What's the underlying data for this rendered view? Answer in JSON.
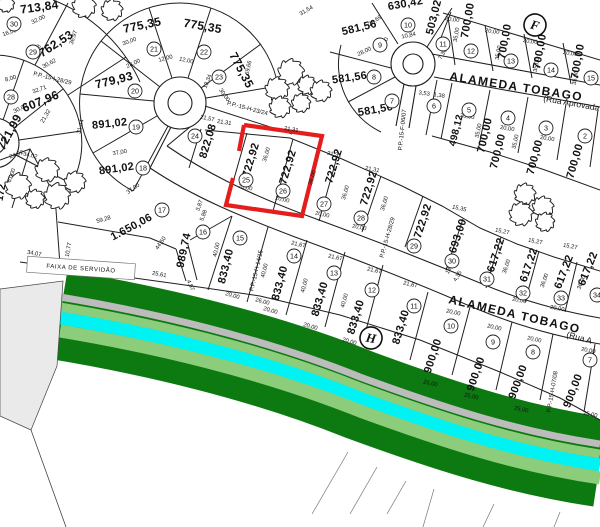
{
  "map": {
    "title_hint": "subdivision plat",
    "colors": {
      "line": "#1f1f1f",
      "highlight_red": "#e51d1d",
      "belt_dark_green": "#0d7a11",
      "belt_light_green": "#8bcd7b",
      "belt_cyan": "#00f2f2",
      "belt_gray": "#bcbcbc",
      "servitude_gray": "#eaeaea"
    },
    "street_labels": [
      {
        "t": "ALAMEDA TOBAGO",
        "x": 449,
        "y": 80,
        "r": 9,
        "s": 12,
        "b": 1,
        "ls": 1.4
      },
      {
        "t": "(Rua Aprovada",
        "x": 543,
        "y": 101,
        "r": 10,
        "s": 8.5,
        "b": 0,
        "ls": 0
      },
      {
        "t": "ALAMEDA TOBAGO",
        "x": 448,
        "y": 303,
        "r": 13,
        "s": 12,
        "b": 1,
        "ls": 1.4
      },
      {
        "t": "(Rua A",
        "x": 566,
        "y": 337,
        "r": 15,
        "s": 8.5,
        "b": 0,
        "ls": 0
      }
    ],
    "boxed_labels": [
      {
        "t": "FAIXA DE SERVIDÃO",
        "x": 81,
        "y": 268,
        "r": 4,
        "s": 6,
        "w": 108,
        "h": 16
      }
    ],
    "refs": [
      {
        "t": "P.P.-15-I-28/29",
        "x": 52,
        "y": 80,
        "r": 14
      },
      {
        "t": "P.P.-15-H-23/24",
        "x": 247,
        "y": 110,
        "r": 15
      },
      {
        "t": "P.P.-15-H-14/15",
        "x": 258,
        "y": 271,
        "r": -77
      },
      {
        "t": "P.P.-15-H-28/29",
        "x": 389,
        "y": 238,
        "r": -74
      },
      {
        "t": "P.P.-15-H-07/08",
        "x": 554,
        "y": 392,
        "r": -80
      },
      {
        "t": "P.P.-15-F-06/07",
        "x": 404,
        "y": 130,
        "r": -84
      }
    ],
    "markers": [
      {
        "t": "F",
        "x": 535,
        "y": 25,
        "r": 15
      },
      {
        "t": "H",
        "x": 371,
        "y": 338,
        "r": 10
      }
    ],
    "selected_lot": "26",
    "lots": [
      {
        "n": "30",
        "cx": 14,
        "cy": 24,
        "a": "713,84",
        "tx": 40,
        "ty": 11,
        "rot": -8,
        "fs": 12
      },
      {
        "n": "29",
        "cx": 33,
        "cy": 52,
        "a": "762,53",
        "tx": 58,
        "ty": 47,
        "rot": -33,
        "fs": 12
      },
      {
        "n": "28",
        "cx": 11,
        "cy": 97,
        "a": "607,96",
        "tx": 42,
        "ty": 105,
        "rot": -22,
        "fs": 12
      },
      {
        "a": "721,99",
        "tx": 13,
        "ty": 134,
        "rot": -62,
        "fs": 12
      },
      {
        "n": "19",
        "cx": 136,
        "cy": 127,
        "a": "891,02",
        "tx": 110,
        "ty": 127,
        "rot": -6,
        "fs": 11
      },
      {
        "n": "18",
        "cx": 143,
        "cy": 168,
        "a": "891,02",
        "tx": 117,
        "ty": 172,
        "rot": -8,
        "fs": 11
      },
      {
        "n": "17",
        "cx": 162,
        "cy": 210,
        "a": "1.650,06",
        "tx": 133,
        "ty": 230,
        "rot": -28,
        "fs": 11
      },
      {
        "n": "16",
        "cx": 203,
        "cy": 232,
        "a": "989,74",
        "tx": 187,
        "ty": 251,
        "rot": -78,
        "fs": 11
      },
      {
        "n": "20",
        "cx": 135,
        "cy": 91,
        "a": "779,93",
        "tx": 115,
        "ty": 84,
        "rot": -14,
        "fs": 12
      },
      {
        "n": "21",
        "cx": 154,
        "cy": 49,
        "a": "775,35",
        "tx": 143,
        "ty": 29,
        "rot": -12,
        "fs": 12
      },
      {
        "n": "22",
        "cx": 204,
        "cy": 52,
        "a": "775,35",
        "tx": 202,
        "ty": 30,
        "rot": 10,
        "fs": 12
      },
      {
        "n": "23",
        "cx": 219,
        "cy": 77,
        "a": "775,35",
        "tx": 238,
        "ty": 72,
        "rot": 62,
        "fs": 12
      },
      {
        "n": "24",
        "cx": 195,
        "cy": 136,
        "a": "822,08",
        "tx": 211,
        "ty": 142,
        "rot": -73,
        "fs": 11
      },
      {
        "n": "25",
        "cx": 246,
        "cy": 180,
        "a": "722,92",
        "tx": 254,
        "ty": 161,
        "rot": -73,
        "fs": 11
      },
      {
        "n": "26",
        "cx": 283,
        "cy": 191,
        "a": "722,92",
        "tx": 291,
        "ty": 168,
        "rot": -73,
        "fs": 11
      },
      {
        "n": "27",
        "cx": 324,
        "cy": 204,
        "a": "722,92",
        "tx": 337,
        "ty": 167,
        "rot": -73,
        "fs": 11
      },
      {
        "n": "28",
        "cx": 361,
        "cy": 218,
        "a": "722,92",
        "tx": 372,
        "ty": 189,
        "rot": -73,
        "fs": 11
      },
      {
        "n": "29",
        "cx": 414,
        "cy": 246,
        "a": "722,92",
        "tx": 426,
        "ty": 222,
        "rot": -72,
        "fs": 11
      },
      {
        "n": "30",
        "cx": 452,
        "cy": 261,
        "a": "693,00",
        "tx": 461,
        "ty": 237,
        "rot": -72,
        "fs": 11
      },
      {
        "n": "31",
        "cx": 487,
        "cy": 279,
        "a": "617,22",
        "tx": 499,
        "ty": 256,
        "rot": -72,
        "fs": 11
      },
      {
        "n": "32",
        "cx": 523,
        "cy": 293,
        "a": "617,22",
        "tx": 532,
        "ty": 266,
        "rot": -71,
        "fs": 11
      },
      {
        "n": "33",
        "cx": 561,
        "cy": 298,
        "a": "617,22",
        "tx": 567,
        "ty": 273,
        "rot": -69,
        "fs": 11
      },
      {
        "n": "34",
        "cx": 597,
        "cy": 295,
        "a": "617,22",
        "tx": 591,
        "ty": 270,
        "rot": -68,
        "fs": 11
      },
      {
        "n": "10",
        "cx": 408,
        "cy": 25,
        "a": "630,42",
        "tx": 406,
        "ty": 7,
        "rot": -10,
        "fs": 11
      },
      {
        "n": "11",
        "cx": 443,
        "cy": 44,
        "a": "503,02",
        "tx": 437,
        "ty": 18,
        "rot": -76,
        "fs": 11
      },
      {
        "n": "9",
        "cx": 380,
        "cy": 45,
        "a": "581,56",
        "tx": 360,
        "ty": 31,
        "rot": -14,
        "fs": 11
      },
      {
        "n": "8",
        "cx": 374,
        "cy": 77,
        "a": "581,56",
        "tx": 350,
        "ty": 81,
        "rot": -8,
        "fs": 11
      },
      {
        "n": "7",
        "cx": 392,
        "cy": 101,
        "a": "581,56",
        "tx": 376,
        "ty": 113,
        "rot": -10,
        "fs": 11
      },
      {
        "n": "12",
        "cx": 471,
        "cy": 51,
        "a": "700,00",
        "tx": 471,
        "ty": 21,
        "rot": -80,
        "fs": 11
      },
      {
        "n": "13",
        "cx": 511,
        "cy": 61,
        "a": "700,00",
        "tx": 508,
        "ty": 42,
        "rot": -80,
        "fs": 11
      },
      {
        "n": "14",
        "cx": 551,
        "cy": 70,
        "a": "700,00",
        "tx": 543,
        "ty": 52,
        "rot": -80,
        "fs": 11
      },
      {
        "n": "15",
        "cx": 591,
        "cy": 78,
        "a": "700,00",
        "tx": 581,
        "ty": 62,
        "rot": -80,
        "fs": 11
      },
      {
        "n": "6",
        "cx": 434,
        "cy": 106,
        "a": "498,12",
        "tx": 459,
        "ty": 131,
        "rot": -76,
        "fs": 10
      },
      {
        "n": "5",
        "cx": 469,
        "cy": 110,
        "a": "700,00",
        "tx": 488,
        "ty": 136,
        "rot": -77,
        "fs": 11
      },
      {
        "n": "4",
        "cx": 508,
        "cy": 118,
        "a": "700,00",
        "tx": 501,
        "ty": 152,
        "rot": -76,
        "fs": 11
      },
      {
        "n": "3",
        "cx": 546,
        "cy": 128,
        "a": "700,00",
        "tx": 538,
        "ty": 158,
        "rot": -75,
        "fs": 11
      },
      {
        "n": "2",
        "cx": 585,
        "cy": 136,
        "a": "700,00",
        "tx": 578,
        "ty": 162,
        "rot": -74,
        "fs": 11
      },
      {
        "n": "15",
        "cx": 240,
        "cy": 238,
        "a": "833,40",
        "tx": 229,
        "ty": 267,
        "rot": -76,
        "fs": 11
      },
      {
        "n": "14",
        "cx": 294,
        "cy": 256,
        "a": "833,40",
        "tx": 283,
        "ty": 284,
        "rot": -75,
        "fs": 11
      },
      {
        "n": "13",
        "cx": 334,
        "cy": 273,
        "a": "833,40",
        "tx": 323,
        "ty": 300,
        "rot": -74,
        "fs": 11
      },
      {
        "n": "12",
        "cx": 372,
        "cy": 290,
        "a": "833,40",
        "tx": 359,
        "ty": 318,
        "rot": -73,
        "fs": 11
      },
      {
        "n": "11",
        "cx": 414,
        "cy": 306,
        "a": "833,40",
        "tx": 404,
        "ty": 328,
        "rot": -73,
        "fs": 11
      },
      {
        "n": "10",
        "cx": 451,
        "cy": 326,
        "a": "900,00",
        "tx": 436,
        "ty": 357,
        "rot": -72,
        "fs": 11
      },
      {
        "n": "9",
        "cx": 493,
        "cy": 342,
        "a": "900,00",
        "tx": 479,
        "ty": 375,
        "rot": -71,
        "fs": 11
      },
      {
        "n": "8",
        "cx": 533,
        "cy": 352,
        "a": "900,00",
        "tx": 521,
        "ty": 383,
        "rot": -70,
        "fs": 11
      },
      {
        "n": "7",
        "cx": 590,
        "cy": 360,
        "a": "900,00",
        "tx": 576,
        "ty": 392,
        "rot": -69,
        "fs": 11
      }
    ],
    "partials": [
      {
        "t": "172",
        "x": 4,
        "y": 193,
        "r": -80,
        "s": 10
      }
    ],
    "dims": [
      [
        "32,00",
        39,
        21,
        -25
      ],
      [
        "16,00",
        10,
        34,
        -18
      ],
      [
        "10,48",
        37,
        52,
        -55
      ],
      [
        "36,97",
        75,
        38,
        -72
      ],
      [
        "30,62",
        50,
        65,
        -28
      ],
      [
        "8,00",
        11,
        80,
        -15
      ],
      [
        "32,71",
        40,
        91,
        -20
      ],
      [
        "30,00",
        21,
        110,
        -25
      ],
      [
        "21,32",
        47,
        117,
        -60
      ],
      [
        "31,44",
        82,
        127,
        -75
      ],
      [
        "24,02",
        17,
        156,
        -20
      ],
      [
        "34,02",
        30,
        157,
        12
      ],
      [
        "61,00",
        13,
        176,
        -70
      ],
      [
        "34,07",
        34,
        255,
        10
      ],
      [
        "10,77",
        70,
        250,
        -80
      ],
      [
        "40,60",
        90,
        266,
        8
      ],
      [
        "25,61",
        159,
        276,
        10
      ],
      [
        "4,97",
        189,
        286,
        65
      ],
      [
        "37,00",
        120,
        154,
        -10
      ],
      [
        "37,00",
        134,
        190,
        -35
      ],
      [
        "59,28",
        104,
        221,
        -16
      ],
      [
        "44,50",
        162,
        244,
        -55
      ],
      [
        "30,00",
        130,
        43,
        -20
      ],
      [
        "28,00",
        134,
        65,
        -25
      ],
      [
        "12,00",
        166,
        60,
        -15
      ],
      [
        "12,00",
        186,
        62,
        12
      ],
      [
        "13,34",
        209,
        82,
        -68
      ],
      [
        "30,00",
        223,
        96,
        55
      ],
      [
        "69,66",
        250,
        68,
        -78
      ],
      [
        "31,54",
        307,
        12,
        -30
      ],
      [
        "28,69",
        376,
        22,
        -35
      ],
      [
        "10,84",
        409,
        37,
        -12
      ],
      [
        "10,00",
        386,
        45,
        -70
      ],
      [
        "28,00",
        365,
        53,
        -25
      ],
      [
        "7,36",
        444,
        55,
        -60
      ],
      [
        "3,53",
        424,
        95,
        8
      ],
      [
        "1,38",
        439,
        97,
        8
      ],
      [
        "21,57",
        207,
        120,
        12
      ],
      [
        "21,31",
        224,
        124,
        9
      ],
      [
        "21,31",
        291,
        131,
        9
      ],
      [
        "21,31",
        334,
        156,
        11
      ],
      [
        "21,31",
        372,
        171,
        11
      ],
      [
        "36,00",
        268,
        155,
        -73
      ],
      [
        "36,00",
        314,
        178,
        -73
      ],
      [
        "36,00",
        347,
        193,
        -73
      ],
      [
        "36,00",
        386,
        204,
        -73
      ],
      [
        "36,00",
        508,
        267,
        -72
      ],
      [
        "36,00",
        546,
        281,
        -71
      ],
      [
        "36,00",
        583,
        283,
        -69
      ],
      [
        "20,00",
        245,
        189,
        12
      ],
      [
        "20,00",
        282,
        201,
        12
      ],
      [
        "20,00",
        322,
        216,
        12
      ],
      [
        "20,00",
        359,
        229,
        12
      ],
      [
        "20,00",
        519,
        302,
        11
      ],
      [
        "20,00",
        557,
        310,
        10
      ],
      [
        "15,35",
        459,
        210,
        12
      ],
      [
        "15,27",
        502,
        233,
        12
      ],
      [
        "15,27",
        535,
        243,
        11
      ],
      [
        "15,27",
        570,
        248,
        10
      ],
      [
        "14,31",
        452,
        268,
        -60
      ],
      [
        "4,35",
        459,
        277,
        -60
      ],
      [
        "5,88",
        205,
        216,
        -70
      ],
      [
        "3,87",
        201,
        206,
        -70
      ],
      [
        "21,67",
        298,
        246,
        13
      ],
      [
        "21,67",
        335,
        259,
        13
      ],
      [
        "21,67",
        374,
        272,
        13
      ],
      [
        "21,67",
        410,
        286,
        13
      ],
      [
        "40,00",
        218,
        250,
        -77
      ],
      [
        "40,00",
        266,
        271,
        -76
      ],
      [
        "40,00",
        306,
        286,
        -75
      ],
      [
        "40,00",
        346,
        301,
        -74
      ],
      [
        "20,00",
        232,
        297,
        16
      ],
      [
        "20,00",
        270,
        312,
        16
      ],
      [
        "20,00",
        310,
        328,
        16
      ],
      [
        "20,00",
        349,
        343,
        16
      ],
      [
        "26,00",
        262,
        303,
        15
      ],
      [
        "20,00",
        453,
        314,
        13
      ],
      [
        "20,00",
        494,
        329,
        13
      ],
      [
        "20,00",
        534,
        341,
        12
      ],
      [
        "20,00",
        588,
        352,
        11
      ],
      [
        "25,00",
        430,
        385,
        13
      ],
      [
        "25,00",
        471,
        398,
        13
      ],
      [
        "25,00",
        521,
        411,
        12
      ],
      [
        "25,00",
        590,
        416,
        10
      ],
      [
        "35,00",
        458,
        35,
        -80
      ],
      [
        "35,00",
        500,
        53,
        -80
      ],
      [
        "35,00",
        538,
        65,
        -80
      ],
      [
        "35,00",
        577,
        78,
        -80
      ],
      [
        "35,00",
        480,
        131,
        -78
      ],
      [
        "35,00",
        517,
        142,
        -77
      ],
      [
        "20,00",
        452,
        21,
        8
      ],
      [
        "20,00",
        492,
        33,
        8
      ],
      [
        "20,00",
        530,
        43,
        8
      ],
      [
        "20,00",
        570,
        55,
        8
      ],
      [
        "20,00",
        467,
        118,
        9
      ],
      [
        "20,00",
        507,
        130,
        9
      ],
      [
        "20,00",
        547,
        140,
        9
      ]
    ],
    "trees": [
      [
        84,
        6,
        10
      ],
      [
        112,
        10,
        9
      ],
      [
        6,
        4,
        7
      ],
      [
        291,
        72,
        11
      ],
      [
        277,
        89,
        10
      ],
      [
        307,
        85,
        8
      ],
      [
        321,
        91,
        9
      ],
      [
        280,
        107,
        9
      ],
      [
        301,
        103,
        8
      ],
      [
        47,
        170,
        10
      ],
      [
        18,
        186,
        11
      ],
      [
        57,
        196,
        11
      ],
      [
        75,
        182,
        9
      ],
      [
        35,
        199,
        8
      ],
      [
        525,
        194,
        9
      ],
      [
        543,
        207,
        9
      ],
      [
        521,
        214,
        10
      ],
      [
        545,
        222,
        8
      ]
    ]
  }
}
